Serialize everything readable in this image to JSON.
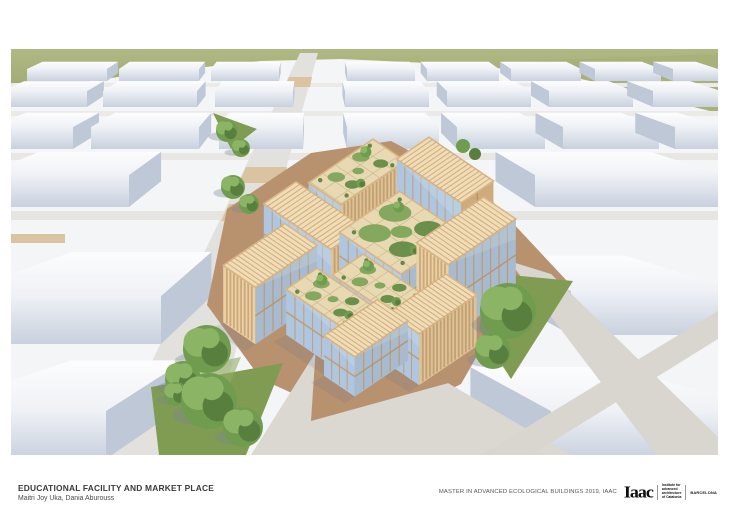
{
  "footer": {
    "title": "EDUCATIONAL FACILITY AND MARKET PLACE",
    "authors": "Maitri Joy Uka, Dania Aburouss",
    "course": "MASTER IN ADVANCED ECOLOGICAL BUILDINGS 2019, IAAC",
    "logo": {
      "wordmark": "Iaac",
      "institute_lines": [
        "Institute for",
        "advanced",
        "architecture",
        "of Catalonia"
      ],
      "city": "BARCELONA"
    }
  },
  "render": {
    "palette": {
      "green_field": "#a9b17b",
      "green_field_dark": "#9aa468",
      "ground": "#f4f5f7",
      "street": "#e2e1dd",
      "street_light": "#eceae6",
      "road_gray": "#d9d5cf",
      "crosswalk_tan": "#d9c3a0",
      "plaza_brown": "#b8926f",
      "plaza_brown_light": "#c5a182",
      "paving_gray": "#dbd7d1",
      "grass": "#809c53",
      "grass_light": "#93ad62",
      "tree_light": "#8cb465",
      "tree_mid": "#6f9c4f",
      "tree_dark": "#587f3e",
      "tree_shadow": "rgba(120,132,155,0.35)",
      "block_top_1": "#fdfdfe",
      "block_top_2": "#eff1f5",
      "block_front_1": "#eef1f6",
      "block_front_2": "#c9d1de",
      "block_side": "#bfc8d6",
      "wood_light": "#ead0a2",
      "wood_mid": "#d8b586",
      "wood_dark": "#b5895c",
      "roof_base": "#f0ddb5",
      "roof_rib": "#c8a273",
      "garden_base": "#e8d9b2",
      "garden_grid": "#cdb78c",
      "garden_green": "#7ba457",
      "garden_green2": "#5e8a42",
      "glass": "#aec6df",
      "glass_light": "#c6d8ea",
      "mullion": "#c49a6a",
      "building_shadow": "rgba(100,112,140,0.16)"
    }
  }
}
